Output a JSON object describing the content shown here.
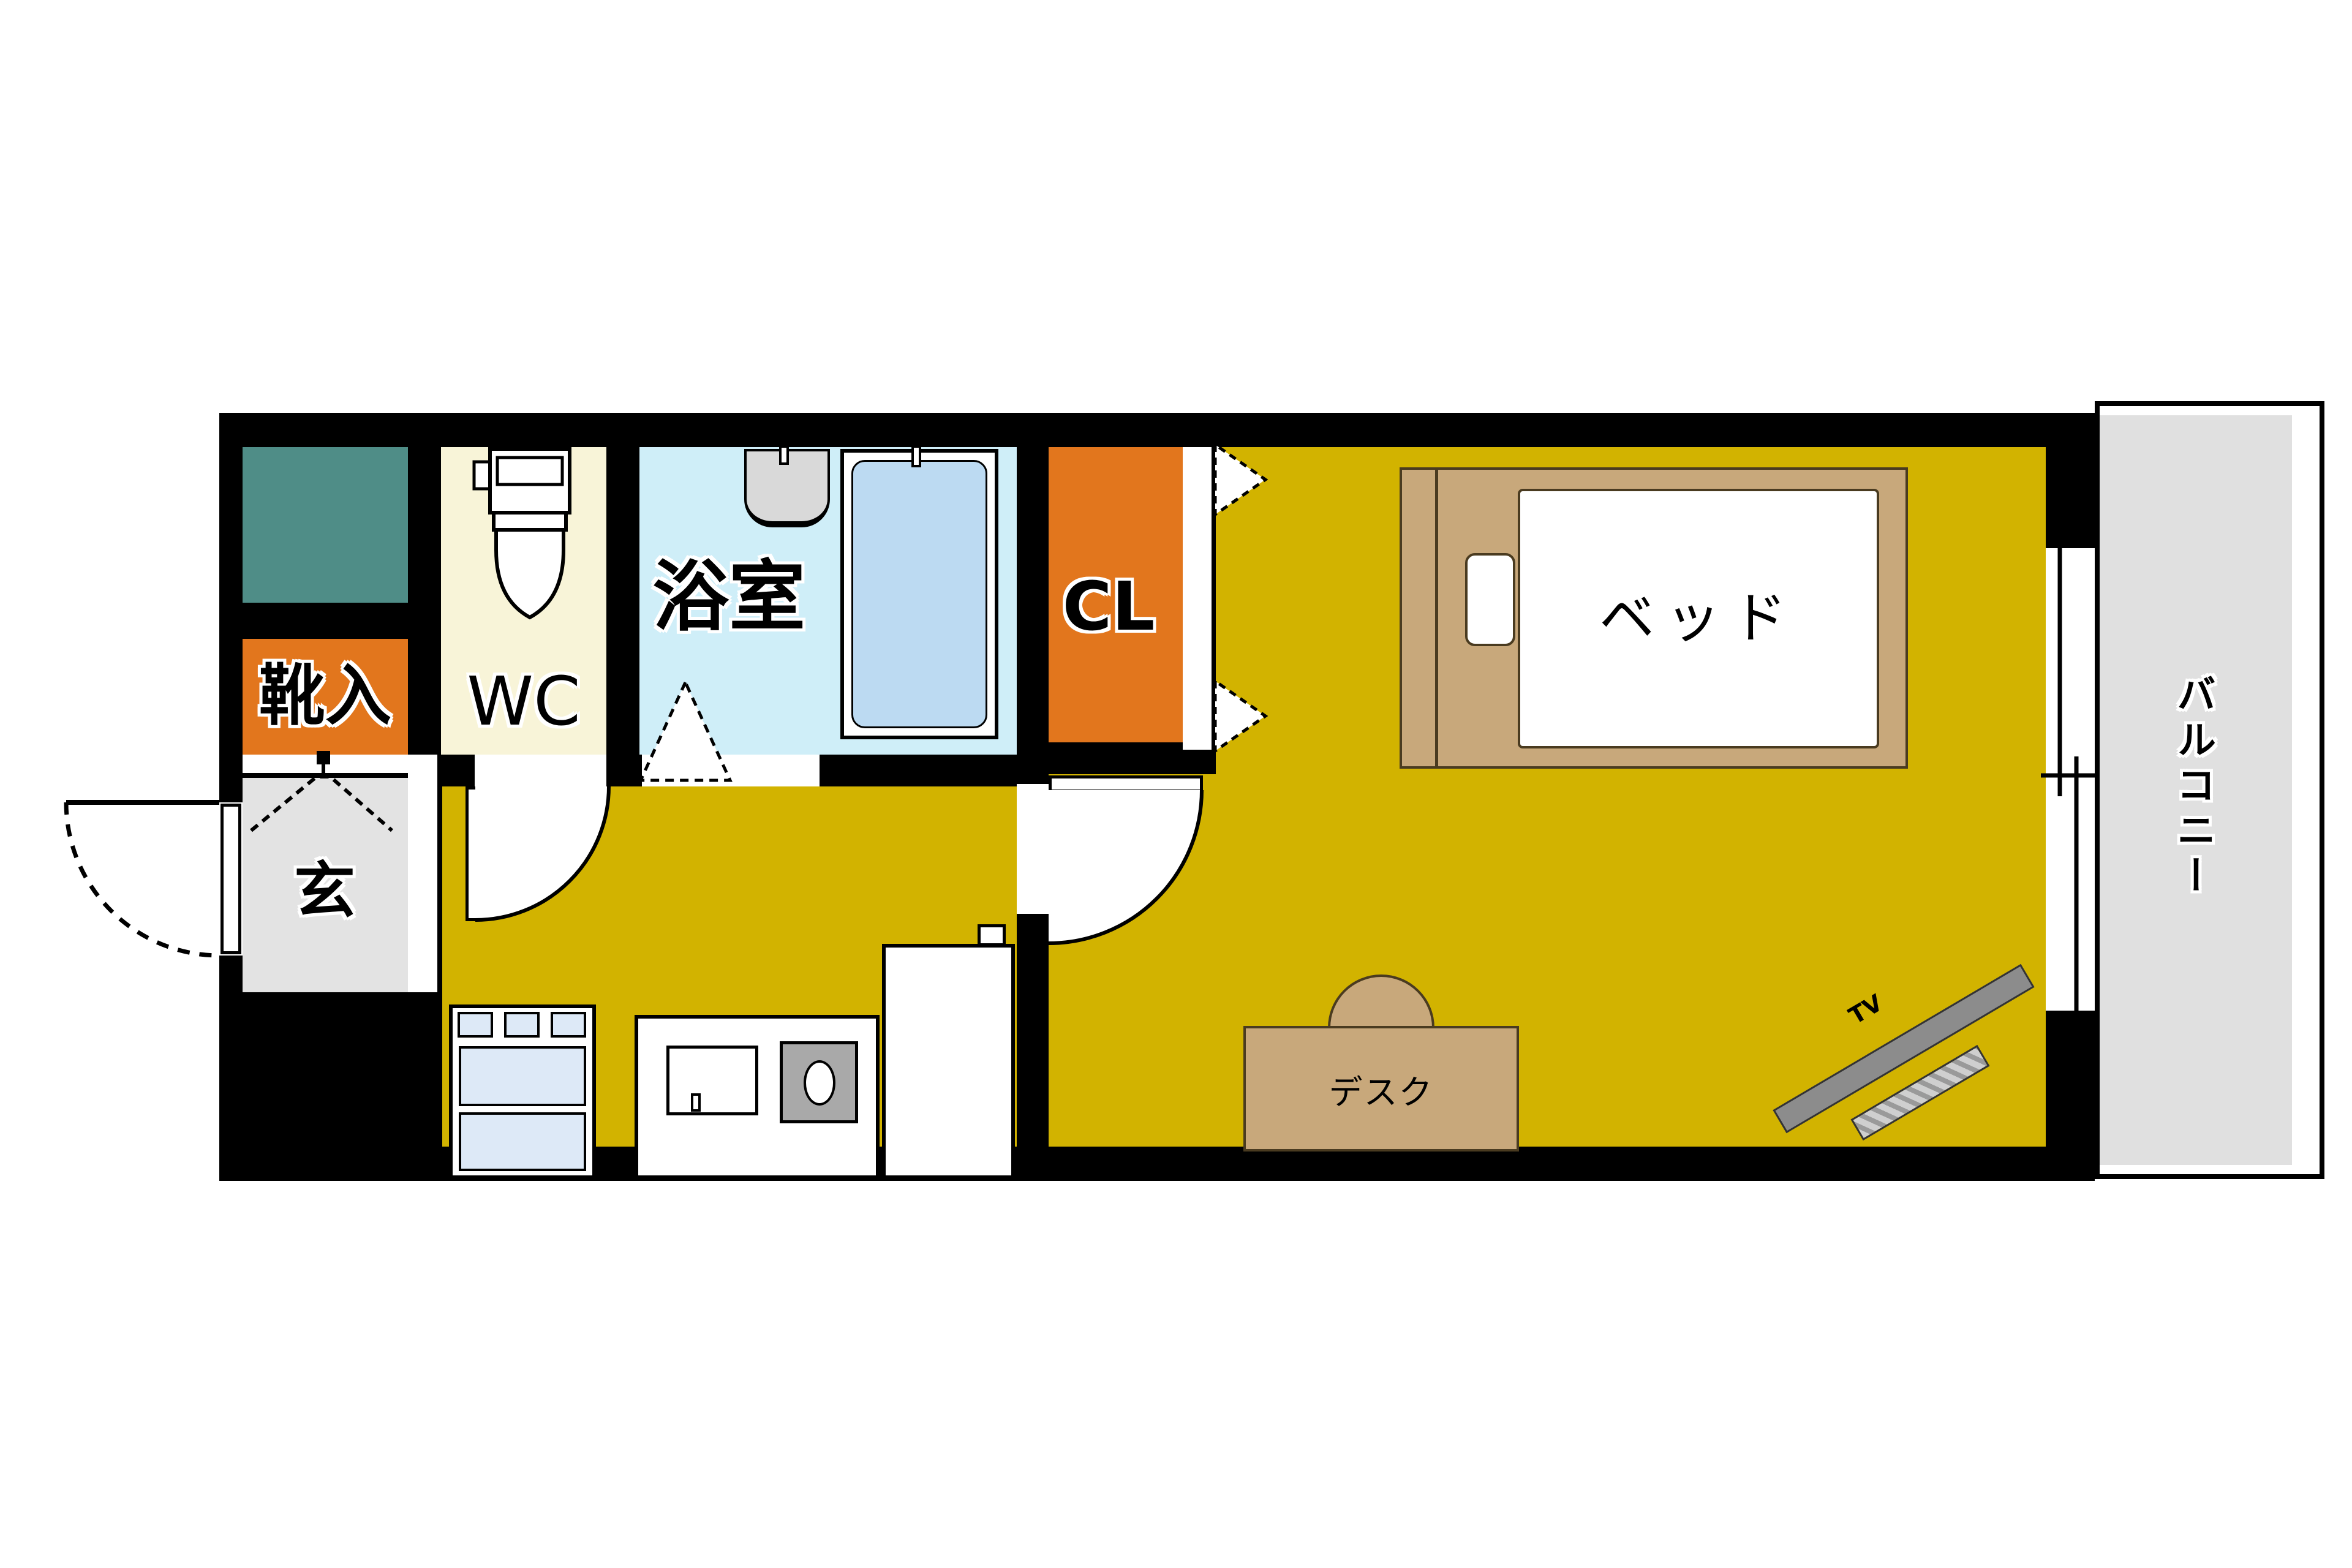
{
  "plan": {
    "rooms": {
      "shoe_cabinet": "靴入",
      "toilet": "WC",
      "bathroom": "浴室",
      "closet": "CL",
      "entrance": "玄",
      "balcony": "バルコニー"
    },
    "furniture": {
      "bed": "ベッド",
      "desk": "デスク",
      "tv": "TV"
    },
    "colors": {
      "wall": "#000000",
      "floor_main": "#d2b300",
      "closet_orange": "#e2761d",
      "utility_teal": "#4f8d87",
      "toilet_cream": "#f8f4d8",
      "bathroom_cyan": "#cfeef8",
      "bathtub_blue": "#bcdaf2",
      "appliance_blue": "#dde9f7",
      "entrance_gray": "#e3e3e3",
      "balcony_gray": "#e0e0e0",
      "wood_tan": "#c8a87b",
      "tv_gray": "#8c8c8c"
    }
  }
}
